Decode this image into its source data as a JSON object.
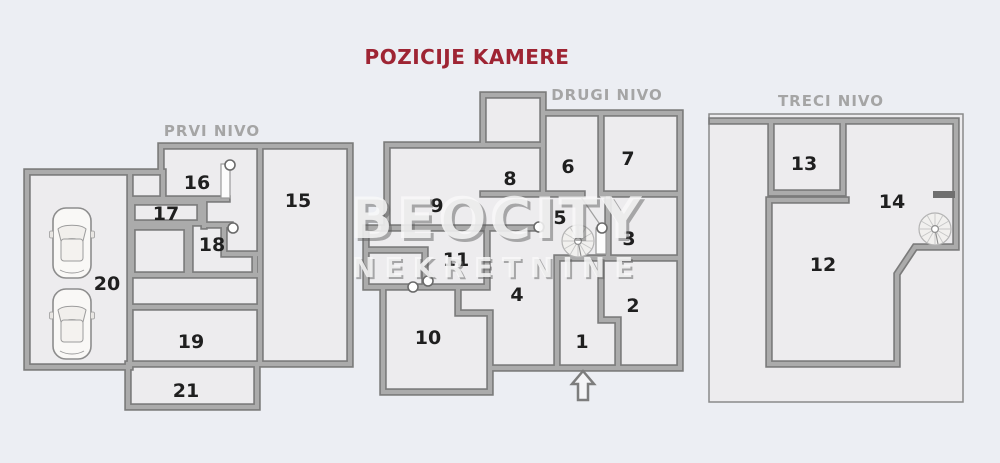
{
  "title": "POZICIJE KAMERE",
  "watermark": {
    "line1": "BEOCITY",
    "line2": "NEKRETNINE"
  },
  "levels": [
    {
      "name": "PRVI NIVO",
      "rooms": [
        "15",
        "16",
        "17",
        "18",
        "19",
        "20",
        "21"
      ]
    },
    {
      "name": "DRUGI NIVO",
      "rooms": [
        "1",
        "2",
        "3",
        "4",
        "5",
        "6",
        "7",
        "8",
        "9",
        "10",
        "11"
      ]
    },
    {
      "name": "TRECI NIVO",
      "rooms": [
        "12",
        "13",
        "14"
      ]
    }
  ],
  "icons": {
    "camera_marker": "small white circle on wall end",
    "spiral_staircase": "circle with radial steps",
    "entrance_arrow": "up arrow at entrance",
    "car": "car top view in garage",
    "door": "white opening in wall"
  },
  "colors": {
    "background": "#eceef3",
    "floor": "#edecee",
    "wall": "#ababab",
    "wall_edge": "#7b7b7b",
    "title": "#9e2433",
    "level_label": "#a5a5a5",
    "room_number": "#1f1f1f"
  }
}
